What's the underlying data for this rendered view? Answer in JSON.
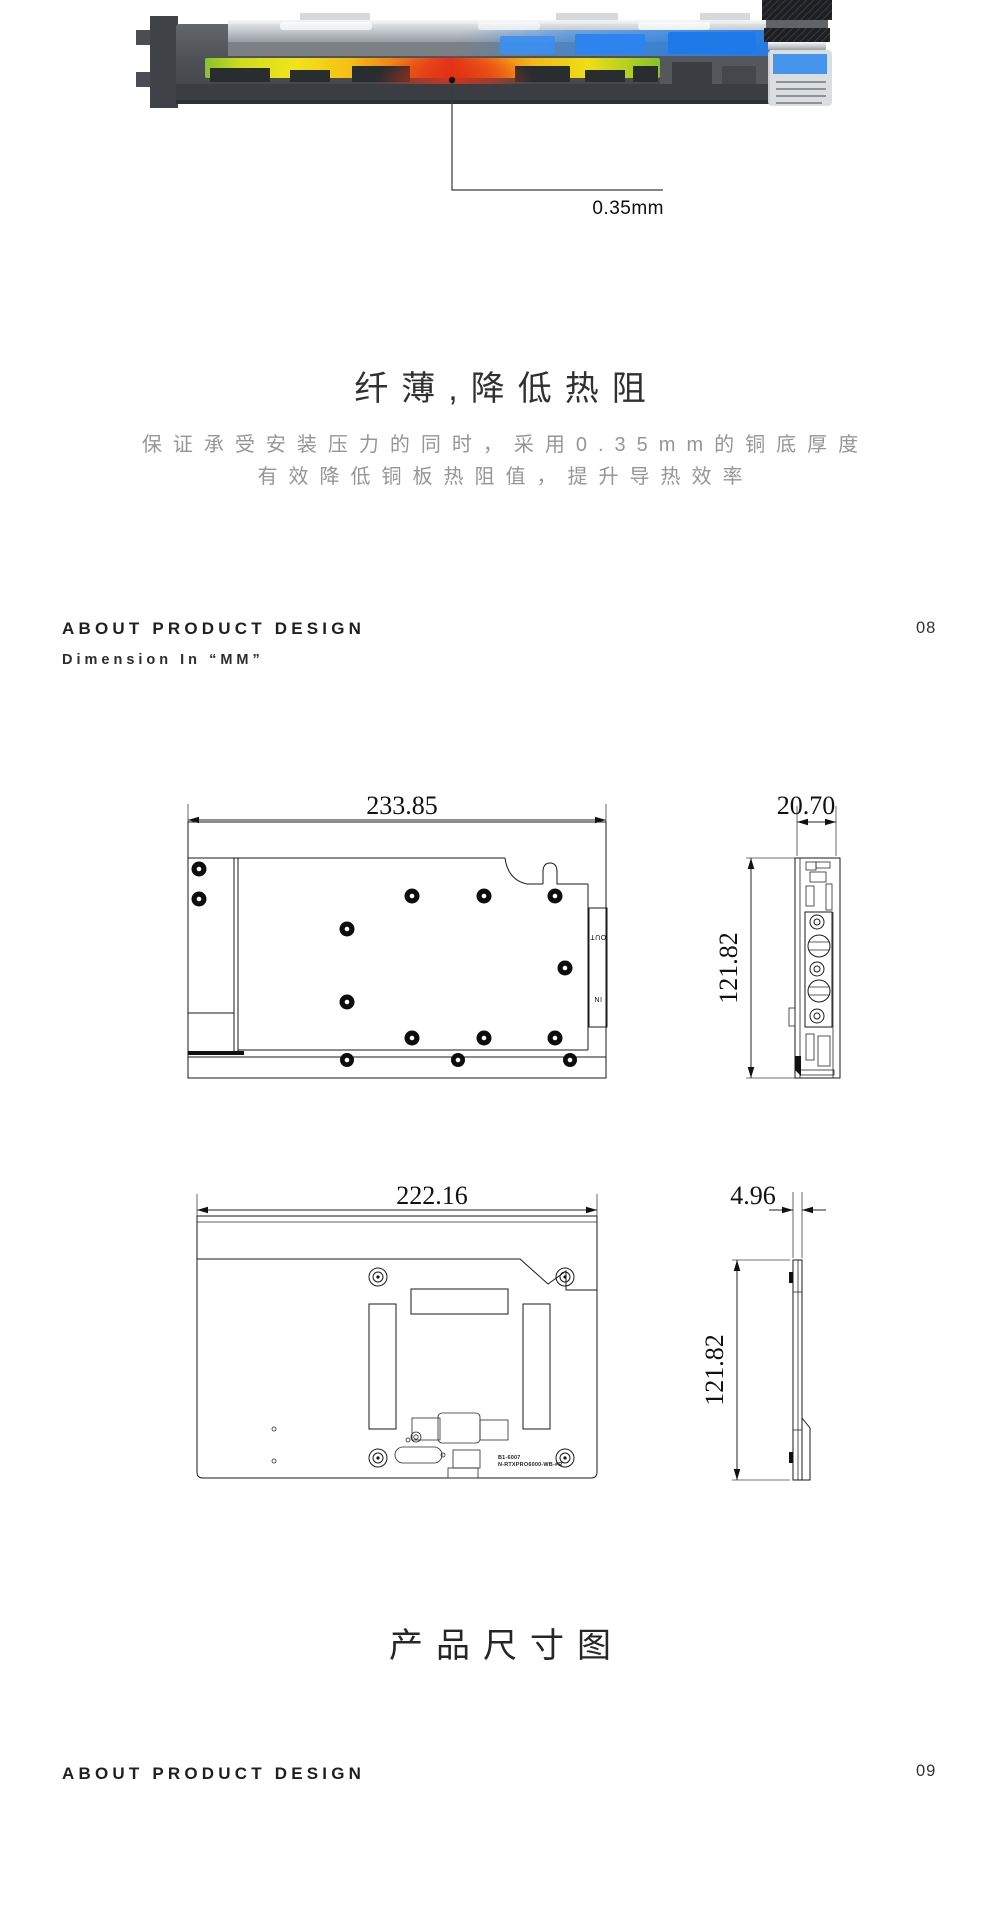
{
  "hero": {
    "label": "0.35mm",
    "colors": {
      "hot_red": "#e5311c",
      "warm_orange": "#f6bd14",
      "cool_green": "#86c426",
      "coolant_blue": "#2b87f0"
    }
  },
  "intro": {
    "title": "纤薄,降低热阻",
    "subtitle_line1": "保证承受安装压力的同时，采用0.35mm的铜底厚度",
    "subtitle_line2": "有效降低铜板热阻值，提升导热效率"
  },
  "section_header": {
    "title": "ABOUT PRODUCT DESIGN",
    "subtitle": "Dimension In “MM”",
    "page_number": "08"
  },
  "drawings": {
    "top_view": {
      "width": "233.85",
      "height": "121.82",
      "depth": "20.70",
      "port_out": "OUT",
      "port_in": "IN"
    },
    "back_view": {
      "width": "222.16",
      "height": "121.82",
      "depth": "4.96",
      "marking_line1": "B1-6007",
      "marking_line2": "N-RTXPRO6000-WB-#R"
    }
  },
  "caption": "产品尺寸图",
  "footer": {
    "title": "ABOUT PRODUCT DESIGN",
    "page_number": "09"
  }
}
